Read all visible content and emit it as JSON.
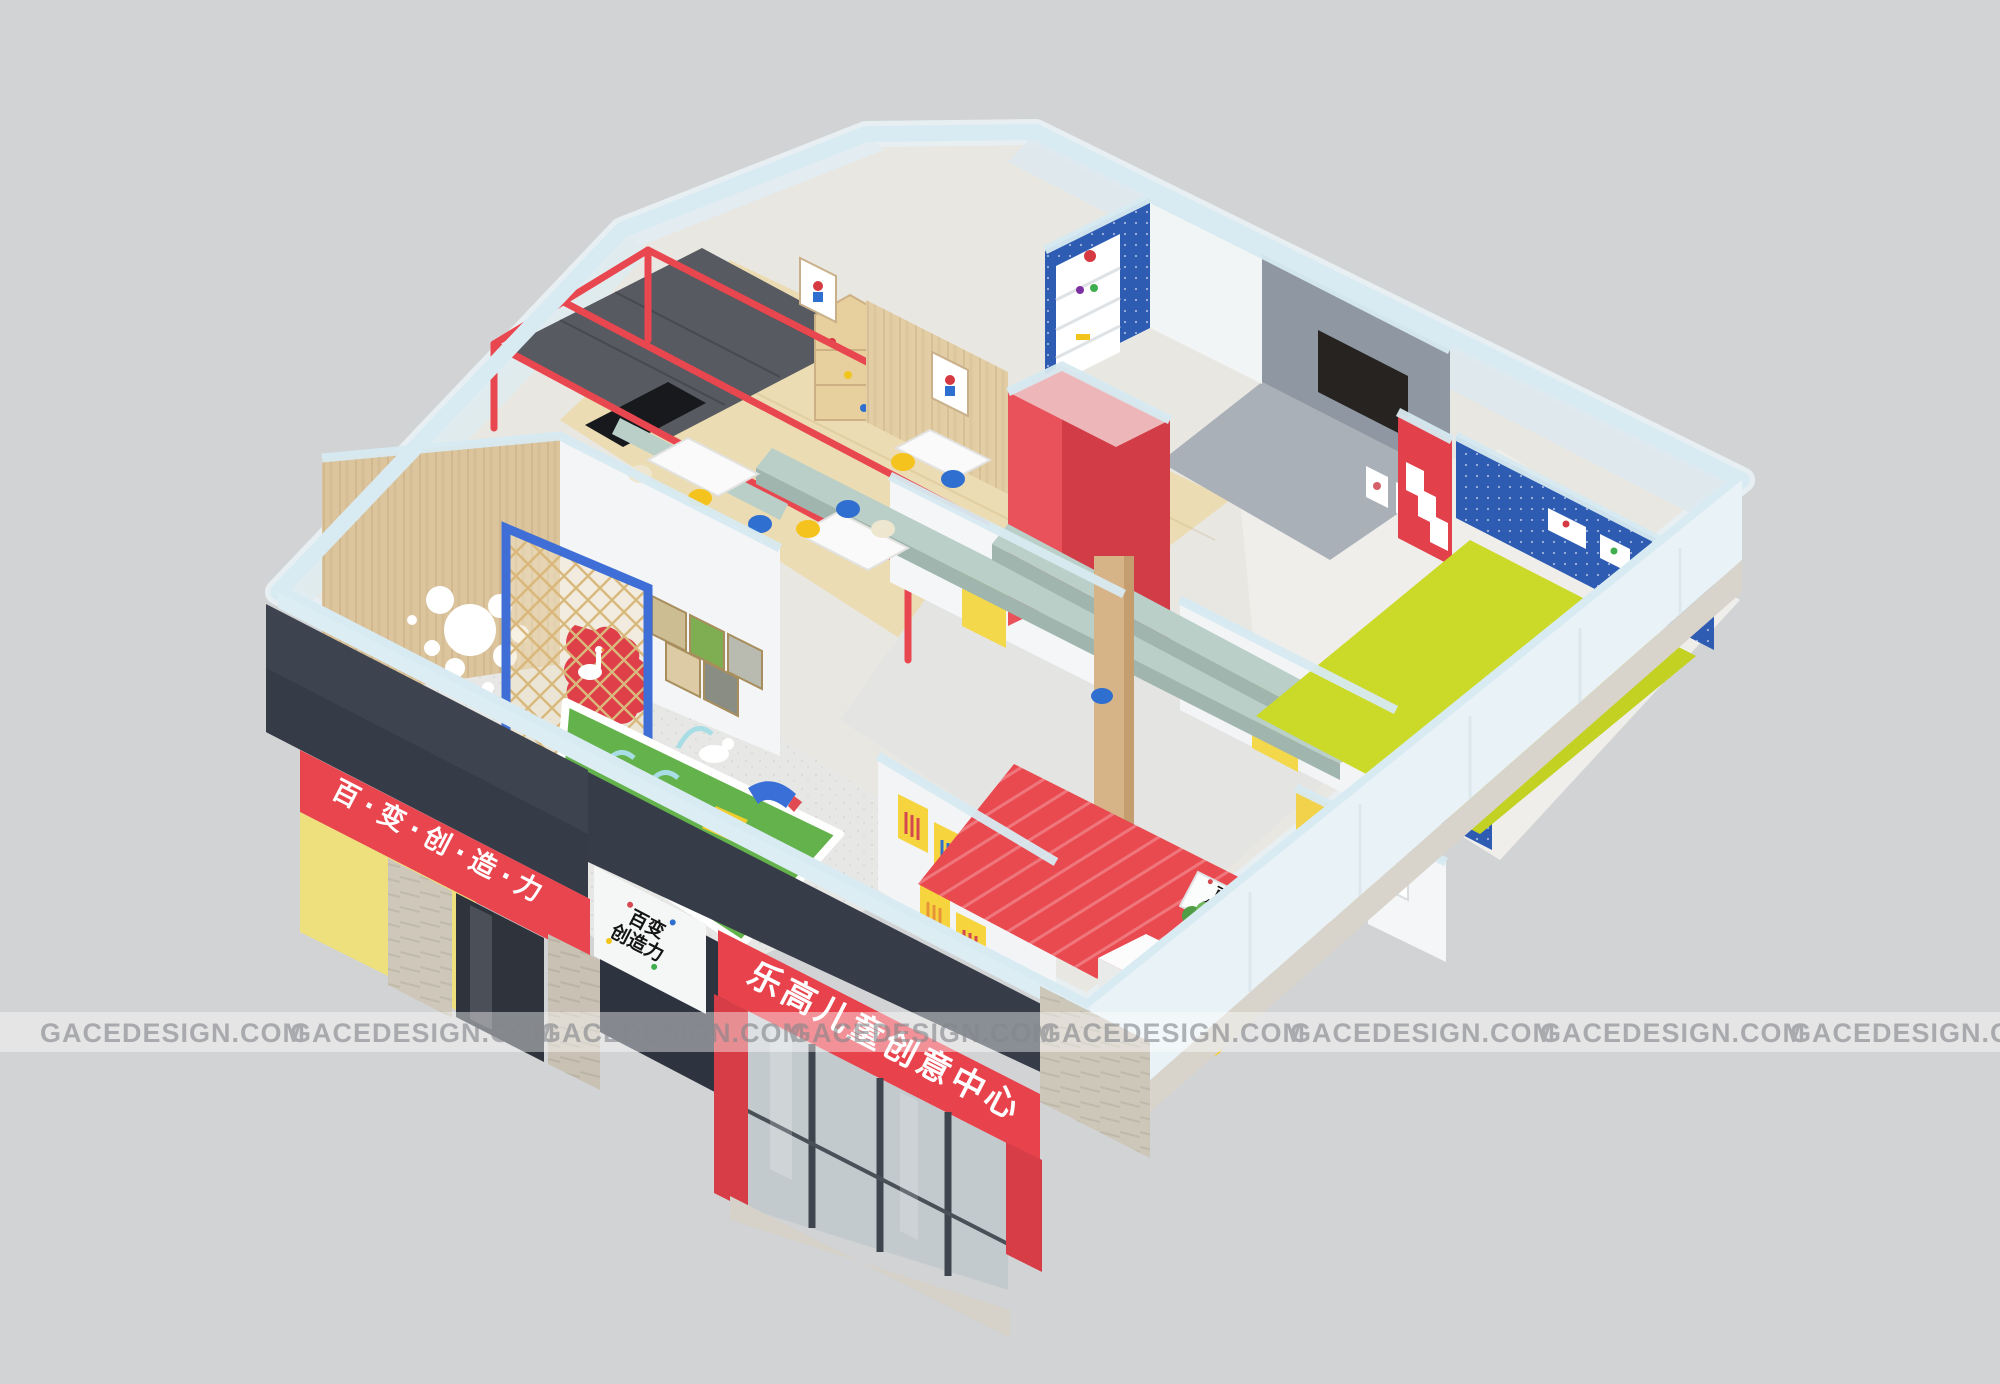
{
  "watermark": {
    "text": "GACEDESIGN.COM",
    "instances": 8
  },
  "signage": {
    "left_band_text": "百·变·创·造·力",
    "main_sign_text": "乐高儿童创意中心",
    "logo_line1": "百变",
    "logo_line2": "创造力",
    "reception_sign_line1": "百变",
    "reception_sign_line2": "创造力"
  },
  "colors": {
    "background": "#d2d3d5",
    "wall_cap_blue": "#d7eaf1",
    "exterior_white_blue": "#e9f2f6",
    "fascia_charcoal": "#3b424e",
    "brand_red": "#e8434c",
    "brand_blue": "#2e5cb2",
    "brand_yellow": "#f5d43e",
    "pale_yellow_panel": "#efe07e",
    "chartreuse_mat": "#c8d92e",
    "grass_green": "#63b24c",
    "sage_beam": "#b9cfc8",
    "light_wood": "#ecdcb4",
    "wood_wall": "#dcc49c",
    "concrete": "#cfc8ba",
    "terrazzo": "#e7e7e5",
    "watermark_text": "#85878b"
  }
}
